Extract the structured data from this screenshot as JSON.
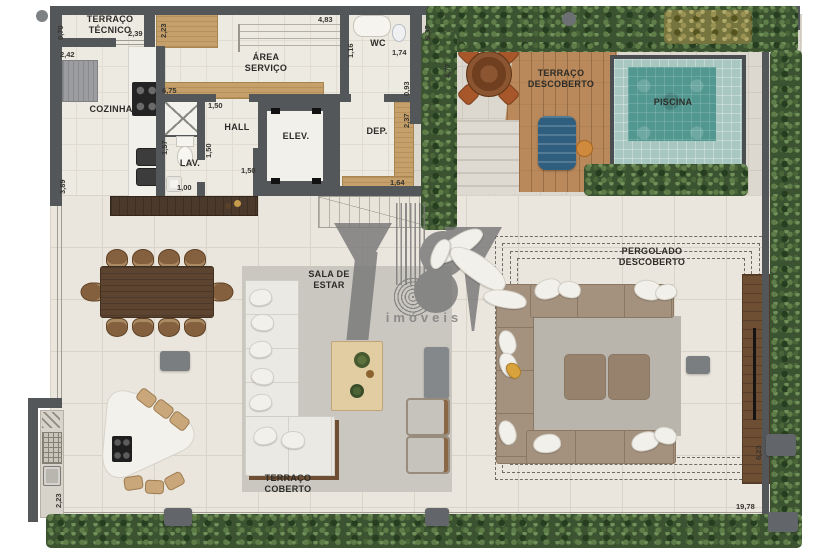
{
  "palette": {
    "wall": "#54575a",
    "floor_indoor": "#edeae2",
    "floor_outdoor": "#dcd8cf",
    "pool_water": "#52948d",
    "hedge_green": "#3b5330",
    "deck_wood": "#b9895b",
    "cabinet_wood": "#c6a06a",
    "watermark_gray": "#787878"
  },
  "watermark": {
    "logo": "YBY",
    "subtext": "imóveis"
  },
  "rooms": {
    "terraco_tecnico": {
      "l1": "TERRAÇO",
      "l2": "TÉCNICO"
    },
    "area_servico": {
      "l1": "ÁREA",
      "l2": "SERVIÇO"
    },
    "wc": {
      "l1": "WC"
    },
    "cozinha": {
      "l1": "COZINHA"
    },
    "hall": {
      "l1": "HALL"
    },
    "lav": {
      "l1": "LAV."
    },
    "elev": {
      "l1": "ELEV."
    },
    "dep": {
      "l1": "DEP."
    },
    "terraco_descoberto": {
      "l1": "TERRAÇO",
      "l2": "DESCOBERTO"
    },
    "piscina": {
      "l1": "PISCINA"
    },
    "sala_estar": {
      "l1": "SALA DE",
      "l2": "ESTAR"
    },
    "pergolado_descoberto": {
      "l1": "PERGOLADO",
      "l2": "DESCOBERTO"
    },
    "terraco_coberto": {
      "l1": "TERRAÇO",
      "l2": "COBERTO"
    }
  },
  "dims": {
    "d070": "0,70",
    "d239": "2,39",
    "d242": "2,42",
    "d223a": "2,23",
    "d483": "4,83",
    "d116": "1,16",
    "d174": "1,74",
    "d093": "0,93",
    "d237": "2,37",
    "d164": "1,64",
    "d675": "6,75",
    "d150a": "1,50",
    "d150b": "1,50",
    "d150c": "1,50",
    "d157": "1,57",
    "d100": "1,00",
    "d389": "3,89",
    "d937": "9,37",
    "d477": "4,77",
    "d1978": "19,78",
    "d623": "6,23",
    "d223b": "2,23"
  }
}
